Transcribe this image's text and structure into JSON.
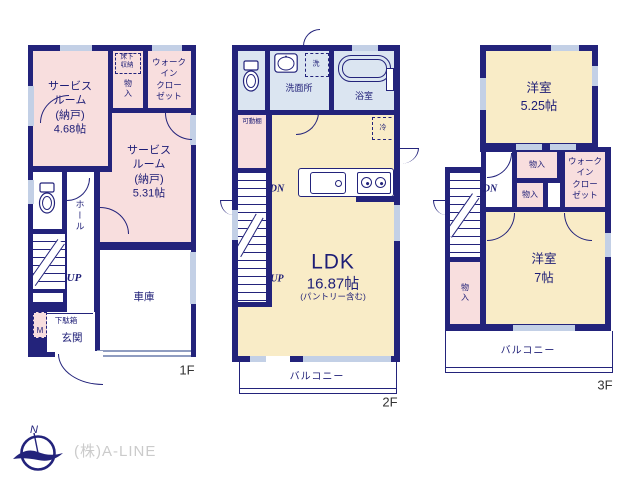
{
  "colors": {
    "wall": "#23237b",
    "room_pink": "#f8dede",
    "room_cream": "#f9ecc7",
    "room_blue": "#dbe5f1",
    "window": "#c3d0e6",
    "text": "#1d1d76",
    "company_gray": "#cbcbcb"
  },
  "floor1": {
    "floor_label": "1F",
    "service_room_a": "サービス\nルーム\n(納戸)\n4.68帖",
    "underfloor_storage": "床下\n収納",
    "storage": "物入",
    "walk_in_closet": "ウォーク\nイン\nクロー\nゼット",
    "service_room_b": "サービス\nルーム\n(納戸)\n5.31帖",
    "hall": "ホール",
    "up": "UP",
    "shoe_cabinet": "下駄箱",
    "meter_box": "M",
    "entrance": "玄関",
    "garage": "車庫"
  },
  "floor2": {
    "floor_label": "2F",
    "washroom": "洗面所",
    "washer": "洗",
    "bathroom": "浴室",
    "movable_shelf": "可動棚",
    "fridge": "冷",
    "down": "DN",
    "up": "UP",
    "ldk_name": "LDK",
    "ldk_area": "16.87帖",
    "ldk_note": "(パントリー含む)",
    "balcony": "バルコニー"
  },
  "floor3": {
    "floor_label": "3F",
    "western_room_a_name": "洋室",
    "western_room_a_area": "5.25帖",
    "storage_a": "物入",
    "storage_b": "物入",
    "storage_c": "物入",
    "walk_in_closet": "ウォーク\nイン\nクロー\nゼット",
    "down": "DN",
    "western_room_b_name": "洋室",
    "western_room_b_area": "7帖",
    "balcony": "バルコニー"
  },
  "footer": {
    "company": "(株)A-LINE",
    "compass_north": "N"
  }
}
